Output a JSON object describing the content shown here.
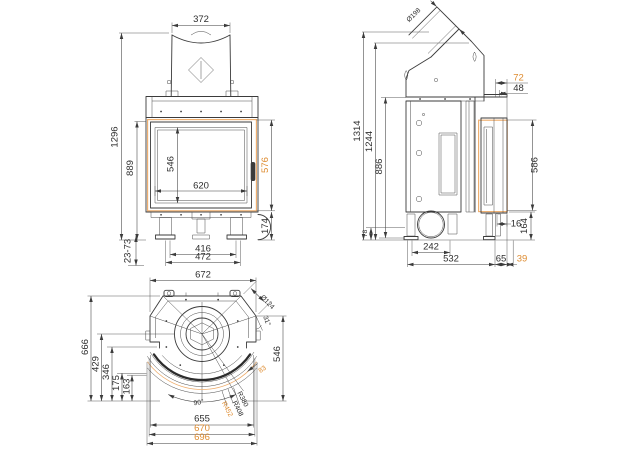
{
  "colors": {
    "line": "#3B3B3B",
    "accent_text": "#DE8B2F",
    "accent_line": "#EFAE6E",
    "background": "#FFFFFF"
  },
  "front_view": {
    "hood_width": "372",
    "overall_height": "1296",
    "body_height": "889",
    "glass_height": "546",
    "glass_width": "620",
    "door_height": "576",
    "base_height": "174",
    "leg_adjust_range": "23-73",
    "leg_span_inner": "416",
    "leg_span_outer": "472"
  },
  "side_view": {
    "flue_diameter": "Ø198",
    "flue_offset": "72",
    "top_depth": "48",
    "overall_height": "1314",
    "flue_outlet_height": "1244",
    "body_height": "886",
    "rear_clearance": "78",
    "door_height": "586",
    "door_gap": "16",
    "base_height": "164",
    "base_span": "242",
    "body_depth": "532",
    "front_depth": "65",
    "door_projection": "39"
  },
  "top_view": {
    "body_width": "672",
    "corner_duct_diameter": "Ø124",
    "corner_angle": "31°",
    "overall_depth": "666",
    "depth_to_flue_center": "429",
    "depth_346": "346",
    "depth_175": "175",
    "depth_163": "163",
    "glass_plane_depth": "546",
    "arc_length_83": "83",
    "door_swing_angle": "90°",
    "radius_inner": "R380",
    "radius_middle": "R408",
    "radius_outer": "R452",
    "width_inner": "655",
    "width_middle": "670",
    "width_outer": "696"
  }
}
